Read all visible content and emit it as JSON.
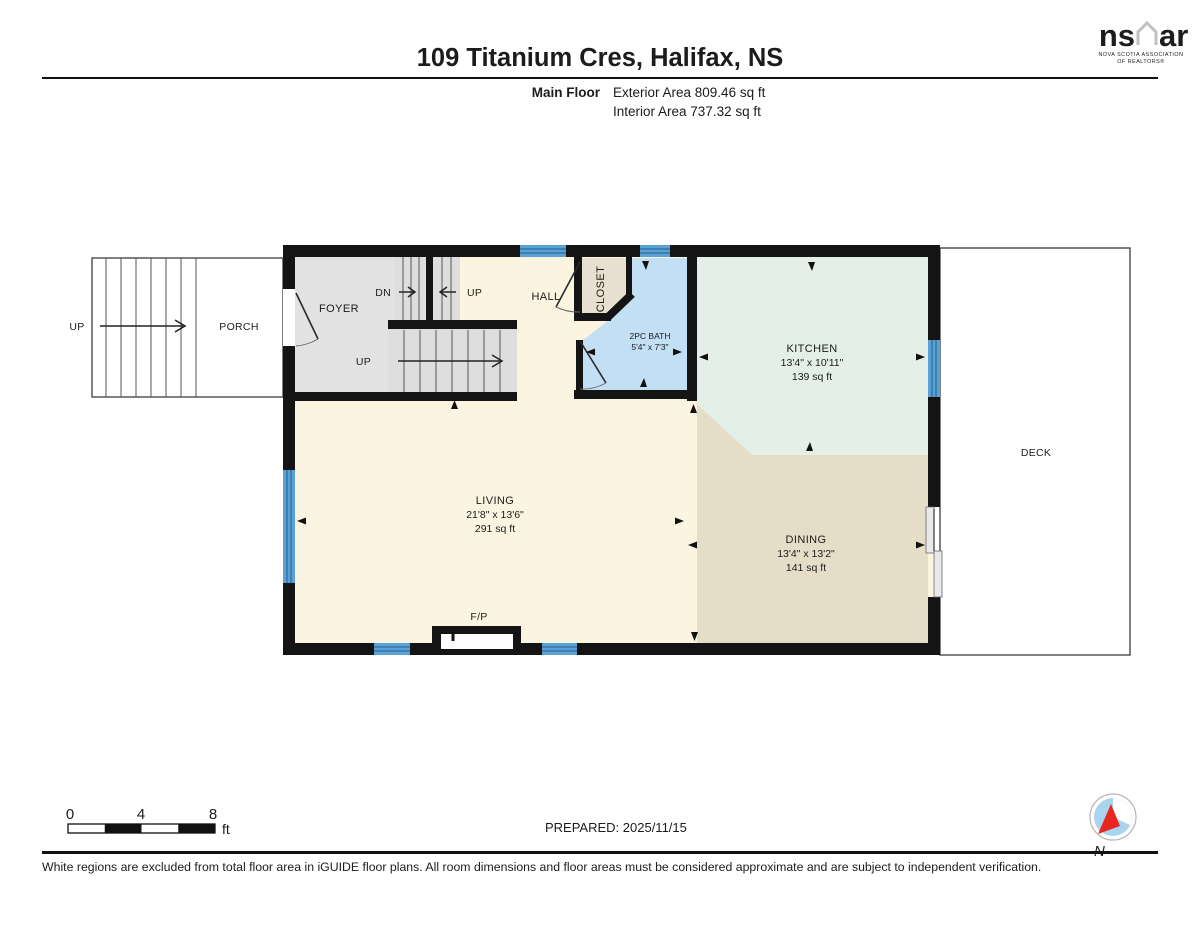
{
  "header": {
    "title": "109 Titanium Cres, Halifax, NS",
    "floor_label": "Main Floor",
    "exterior_area": "Exterior Area 809.46 sq ft",
    "interior_area": "Interior Area 737.32 sq ft"
  },
  "logo": {
    "text_ns": "ns",
    "text_ar": "ar",
    "caption_line1": "NOVA SCOTIA ASSOCIATION",
    "caption_line2": "OF REALTORS®"
  },
  "rooms": {
    "porch": {
      "label": "PORCH"
    },
    "exterior_stairs": {
      "label": "UP"
    },
    "foyer": {
      "label": "FOYER"
    },
    "stairs_dn": {
      "label": "DN"
    },
    "stairs_up_small": {
      "label": "UP"
    },
    "stairs_up_main": {
      "label": "UP"
    },
    "hall": {
      "label": "HALL"
    },
    "closet": {
      "label": "CLOSET"
    },
    "bath": {
      "label": "2PC BATH",
      "dimensions": "5'4\" x 7'3\""
    },
    "kitchen": {
      "label": "KITCHEN",
      "dimensions": "13'4\" x 10'11\"",
      "area": "139 sq ft"
    },
    "living": {
      "label": "LIVING",
      "dimensions": "21'8\" x 13'6\"",
      "area": "291 sq ft"
    },
    "dining": {
      "label": "DINING",
      "dimensions": "13'4\" x 13'2\"",
      "area": "141 sq ft"
    },
    "deck": {
      "label": "DECK"
    },
    "fireplace": {
      "label": "F/P"
    }
  },
  "footer": {
    "scale": {
      "tick0": "0",
      "tick4": "4",
      "tick8": "8",
      "unit": "ft"
    },
    "prepared": "PREPARED: 2025/11/15",
    "compass_label": "N",
    "disclaimer": "White regions are excluded from total floor area in iGUIDE floor plans. All room dimensions and floor areas must be considered approximate and are subject to independent verification."
  },
  "colors": {
    "wall": "#141414",
    "window": "#5aa2d6",
    "living": "#fbf4e1",
    "foyer": "#e2e2e2",
    "closet": "#e7dfcf",
    "bath": "#c3dff4",
    "kitchen": "#e4efe8",
    "dining": "#e6ddc9",
    "compass_red": "#e8251e",
    "logo_gray": "#c2c0c0"
  }
}
